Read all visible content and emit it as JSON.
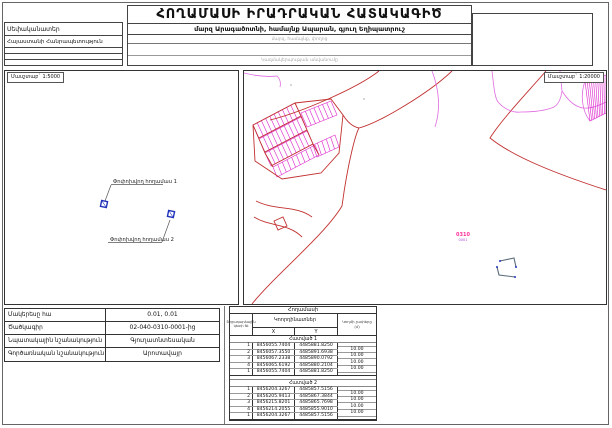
{
  "header": {
    "title": "ՀՈՂԱՄԱՍԻ ԻՐԱԴՐԱԿԱՆ ՀԱՏԱԿԱԳԻԾ",
    "owner_label": "Սեփականատեր",
    "owner_value": "Հայաստանի Հանրապետություն",
    "location_line": "մարզ Արագածոտնի, համայնք Ապարան, գյուղ Եղիպատրուշ",
    "location_hint": "մարզ, համայնք, փողոց",
    "org_hint": "Կազմակերպության անվանումը"
  },
  "maps": {
    "left": {
      "scale_label": "Մասշտաբ` 1:5000",
      "plot1_label": "Փոփոխվող հողամաս 1",
      "plot2_label": "Փոփոխվող հողամաս 2"
    },
    "right": {
      "scale_label": "Մասշտաբ` 1:20000",
      "block_code": "0310",
      "block_subcode": "0001"
    }
  },
  "attributes": {
    "rows": [
      {
        "label": "Մակերեսը հա",
        "value": "0.01, 0.01"
      },
      {
        "label": "Ծածկագիր",
        "value": "02-040-0310-0001-ից"
      },
      {
        "label": "Նպատակային նշանակություն",
        "value": "Գյուղատնտեսական"
      },
      {
        "label": "Գործառնական նշանակություն",
        "value": "Արոտավայր"
      }
    ]
  },
  "coords_table": {
    "title": "Հողամասի",
    "col_point_no": "Շրջադարձային կետի №",
    "col_coords": "Կոորդինատներ",
    "col_x": "X",
    "col_y": "Y",
    "col_side": "Կողմի չափերը (մ)",
    "sections": [
      {
        "name": "Հատված 1",
        "points": [
          {
            "n": "1",
            "x": "8456055.7404",
            "y": "4485881.8250"
          },
          {
            "n": "2",
            "x": "8456057.3550",
            "y": "4485891.6938"
          },
          {
            "n": "3",
            "x": "8456067.2338",
            "y": "4485890.0792"
          },
          {
            "n": "4",
            "x": "8456065.6192",
            "y": "4485880.2104"
          },
          {
            "n": "1",
            "x": "8456055.7404",
            "y": "4485881.8250"
          }
        ],
        "sides": [
          "10.00",
          "10.00",
          "10.00",
          "10.00"
        ]
      },
      {
        "name": "Հատված 2",
        "points": [
          {
            "n": "1",
            "x": "8456204.3267",
            "y": "4485857.5156"
          },
          {
            "n": "2",
            "x": "8456205.9413",
            "y": "4485867.3844"
          },
          {
            "n": "3",
            "x": "8456215.8201",
            "y": "4485865.7698"
          },
          {
            "n": "4",
            "x": "8456214.2055",
            "y": "4485855.9010"
          },
          {
            "n": "1",
            "x": "8456204.3267",
            "y": "4485857.5156"
          }
        ],
        "sides": [
          "10.00",
          "10.00",
          "10.00",
          "10.00"
        ]
      }
    ]
  },
  "colors": {
    "parcel_magenta": "#dd22cc",
    "road_red": "#c23030",
    "contour_violet": "#e06ae0",
    "marker_blue": "#2233bb",
    "block_label_pink": "#ff3399"
  }
}
